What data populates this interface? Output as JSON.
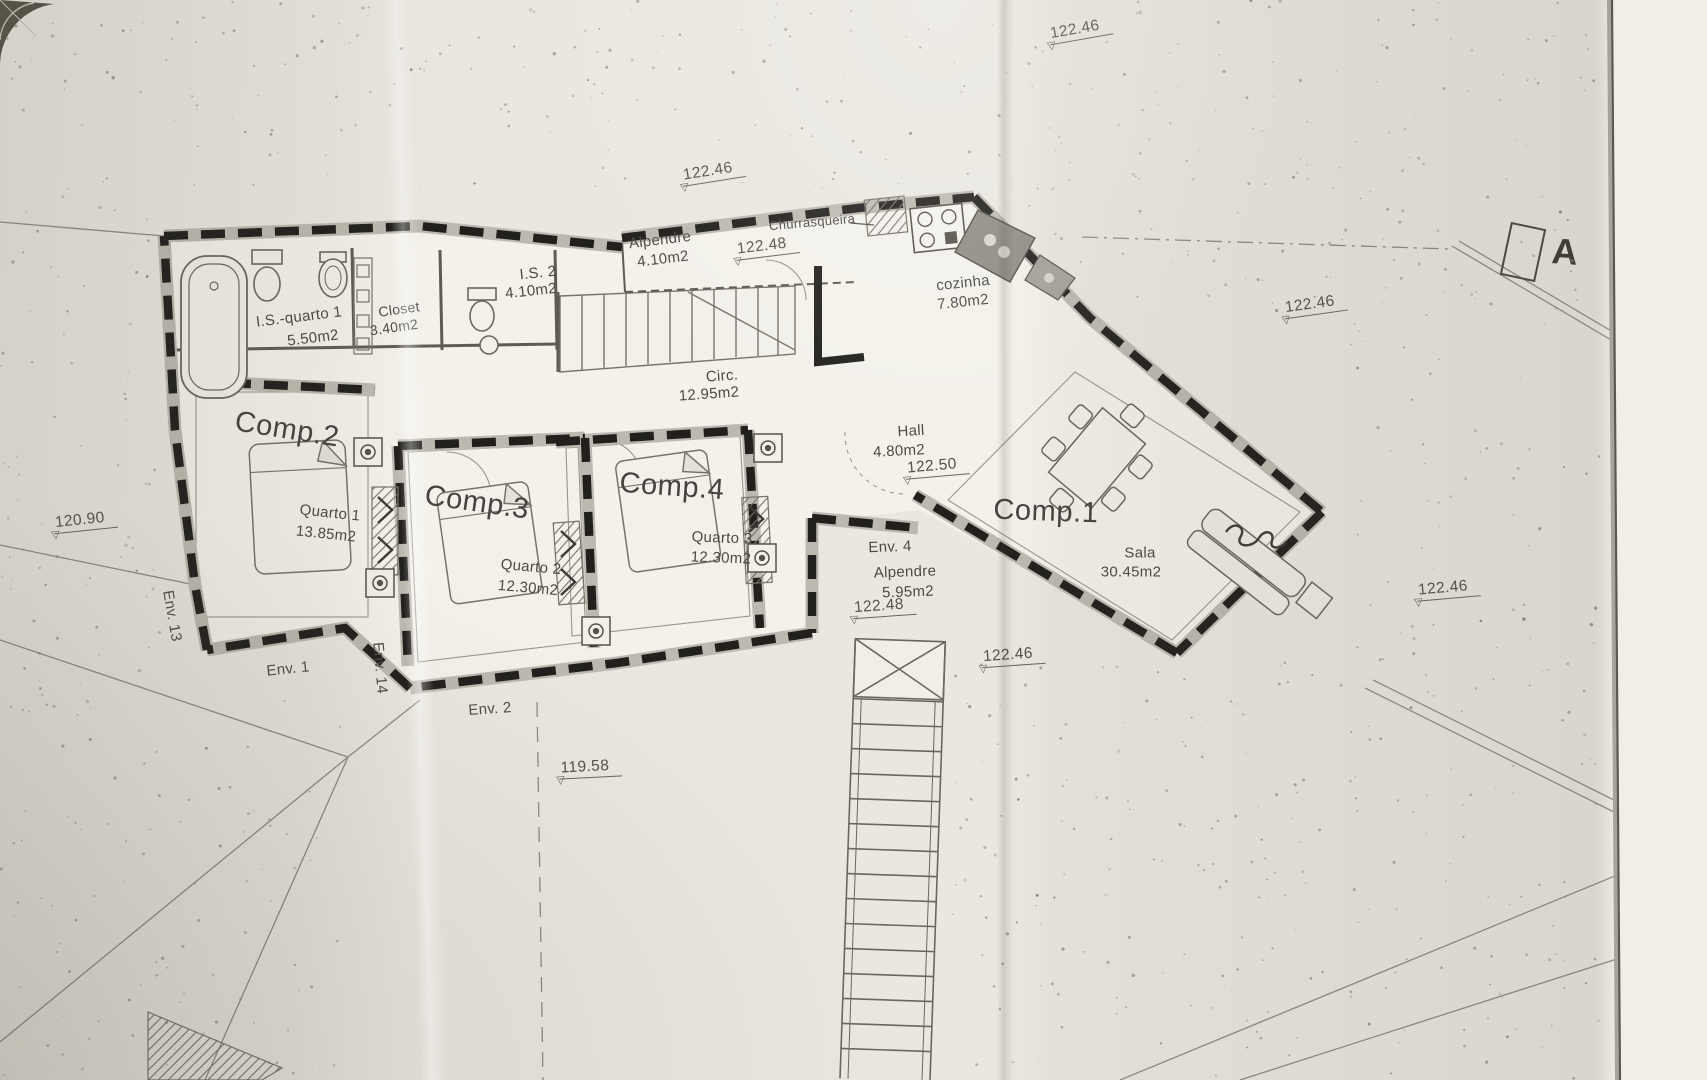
{
  "plan": {
    "room_labels": [
      {
        "t": "Alpendre",
        "x": 660,
        "y": 240,
        "r": -7
      },
      {
        "t": "4.10m2",
        "x": 663,
        "y": 259,
        "r": -7
      },
      {
        "t": "Churrasqueira",
        "x": 812,
        "y": 222,
        "r": -5,
        "s": 13
      },
      {
        "t": "cozinha",
        "x": 963,
        "y": 283,
        "r": -6
      },
      {
        "t": "7.80m2",
        "x": 963,
        "y": 302,
        "r": -6
      },
      {
        "t": "I.S. 2",
        "x": 538,
        "y": 273,
        "r": -6
      },
      {
        "t": "4.10m2",
        "x": 531,
        "y": 291,
        "r": -6
      },
      {
        "t": "Closet",
        "x": 399,
        "y": 309,
        "r": -8,
        "s": 14
      },
      {
        "t": "3.40m2",
        "x": 394,
        "y": 327,
        "r": -8,
        "s": 14
      },
      {
        "t": "I.S.-quarto 1",
        "x": 299,
        "y": 317,
        "r": -7
      },
      {
        "t": "5.50m2",
        "x": 313,
        "y": 338,
        "r": -7
      },
      {
        "t": "Circ.",
        "x": 722,
        "y": 376,
        "r": -4
      },
      {
        "t": "12.95m2",
        "x": 709,
        "y": 394,
        "r": -4
      },
      {
        "t": "Hall",
        "x": 911,
        "y": 431,
        "r": -3
      },
      {
        "t": "4.80m2",
        "x": 899,
        "y": 451,
        "r": -3
      },
      {
        "t": "Comp.2",
        "x": 287,
        "y": 430,
        "r": 9,
        "s": 29
      },
      {
        "t": "Quarto 1",
        "x": 330,
        "y": 513,
        "r": 6
      },
      {
        "t": "13.85m2",
        "x": 326,
        "y": 534,
        "r": 6
      },
      {
        "t": "Comp.3",
        "x": 477,
        "y": 503,
        "r": 8,
        "s": 29
      },
      {
        "t": "Quarto 2",
        "x": 531,
        "y": 567,
        "r": 5
      },
      {
        "t": "12.30m2",
        "x": 528,
        "y": 588,
        "r": 5
      },
      {
        "t": "Comp.4",
        "x": 672,
        "y": 487,
        "r": 4,
        "s": 29
      },
      {
        "t": "Quarto 3",
        "x": 722,
        "y": 538,
        "r": 2
      },
      {
        "t": "12.30m2",
        "x": 721,
        "y": 558,
        "r": 2
      },
      {
        "t": "Env. 4",
        "x": 890,
        "y": 547,
        "r": -2
      },
      {
        "t": "Alpendre",
        "x": 905,
        "y": 572,
        "r": -2
      },
      {
        "t": "5.95m2",
        "x": 908,
        "y": 592,
        "r": -2
      },
      {
        "t": "Comp.1",
        "x": 1046,
        "y": 512,
        "r": 2,
        "s": 29
      },
      {
        "t": "Sala",
        "x": 1140,
        "y": 553,
        "r": 0
      },
      {
        "t": "30.45m2",
        "x": 1131,
        "y": 572,
        "r": 0
      }
    ],
    "env_labels": [
      {
        "t": "Env. 1",
        "x": 288,
        "y": 669,
        "r": -6
      },
      {
        "t": "Env. 2",
        "x": 490,
        "y": 709,
        "r": -4
      },
      {
        "t": "Env. 13",
        "x": 172,
        "y": 616,
        "r": 80
      },
      {
        "t": "Env. 14",
        "x": 380,
        "y": 668,
        "r": 85
      }
    ],
    "elevations": [
      {
        "v": "122.46",
        "x": 1080,
        "y": 30,
        "r": -10
      },
      {
        "v": "122.46",
        "x": 713,
        "y": 172,
        "r": -9
      },
      {
        "v": "122.48",
        "x": 767,
        "y": 247,
        "r": -7
      },
      {
        "v": "122.50",
        "x": 937,
        "y": 467,
        "r": -5
      },
      {
        "v": "122.48",
        "x": 884,
        "y": 607,
        "r": -4
      },
      {
        "v": "122.46",
        "x": 1013,
        "y": 656,
        "r": -4
      },
      {
        "v": "122.46",
        "x": 1315,
        "y": 305,
        "r": -8
      },
      {
        "v": "122.46",
        "x": 1448,
        "y": 589,
        "r": -5
      },
      {
        "v": "120.90",
        "x": 85,
        "y": 521,
        "r": -6
      },
      {
        "v": "119.58",
        "x": 590,
        "y": 768,
        "r": -3
      }
    ]
  },
  "section_marker": {
    "label": "A"
  },
  "title_block": {
    "company_line1": "ENGENHA",
    "company_line2": "URBANIS",
    "address_lines": [
      {
        "t": "Rua João Luís d",
        "y": 84
      },
      {
        "t": "tel.: 261 423 93",
        "y": 98
      },
      {
        "t": "site: www.hartca",
        "y": 112
      }
    ],
    "note_lines": [
      {
        "t": "Este d",
        "y": 154
      },
      {
        "t": "Técnic",
        "y": 167
      },
      {
        "t": "reprod",
        "y": 180
      },
      {
        "t": "sem",
        "y": 193
      },
      {
        "t": "direito",
        "y": 205
      },
      {
        "t": "- Tod",
        "y": 250
      },
      {
        "t": "- Toda",
        "y": 277
      },
      {
        "t": "- A p",
        "y": 326
      },
      {
        "t": "o p",
        "y": 338
      },
      {
        "t": "- Em",
        "y": 350
      }
    ]
  },
  "colors": {
    "paper": "#eae7e0",
    "paper_bright": "#f3f1ea",
    "ink": "#4c4a45",
    "wall": "#201f1c"
  }
}
